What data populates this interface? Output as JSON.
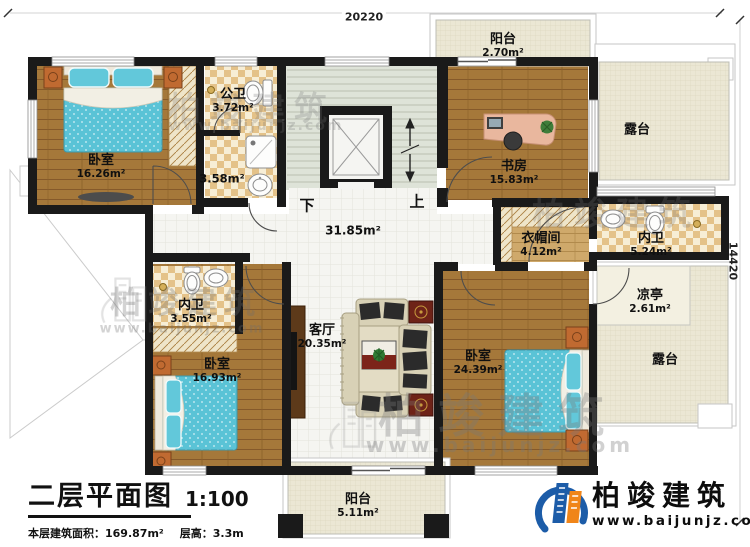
{
  "dimensions": {
    "top": "20220",
    "right": "14420"
  },
  "stairs": {
    "down": "下",
    "up": "上"
  },
  "rooms": {
    "bedroom_tl": {
      "name": "卧室",
      "area": "16.26m²"
    },
    "public_bath": {
      "name": "公卫",
      "area": "3.72m²"
    },
    "shower_room": {
      "area": "3.58m²"
    },
    "hall": {
      "area": "31.85m²"
    },
    "study": {
      "name": "书房",
      "area": "15.83m²"
    },
    "balcony_top": {
      "name": "阳台",
      "area": "2.70m²"
    },
    "terrace_top": {
      "name": "露台"
    },
    "cloakroom": {
      "name": "衣帽间",
      "area": "4.12m²"
    },
    "bath_right": {
      "name": "内卫",
      "area": "5.24m²"
    },
    "pavilion": {
      "name": "凉亭",
      "area": "2.61m²"
    },
    "terrace_right": {
      "name": "露台"
    },
    "bedroom_br": {
      "name": "卧室",
      "area": "24.39m²"
    },
    "living_room": {
      "name": "客厅",
      "area": "20.35m²"
    },
    "bedroom_bl": {
      "name": "卧室",
      "area": "16.93m²"
    },
    "bath_bl": {
      "name": "内卫",
      "area": "3.55m²"
    },
    "balcony_bottom": {
      "name": "阳台",
      "area": "5.11m²"
    }
  },
  "title_block": {
    "title": "二层平面图",
    "scale": "1:100",
    "area_info": "本层建筑面积：169.87m²",
    "height_info": "层高：3.3m"
  },
  "branding": {
    "company": "柏竣建筑",
    "website": "www.baijunjz.com"
  },
  "watermark": {
    "brand": "柏竣建筑",
    "url": "www.baijunjz.com"
  },
  "colors": {
    "wall": "#1a1a1a",
    "wood": "#a5783a",
    "tile_check": "#e4c289",
    "bed": "#5ac3d6",
    "accent_orange": "#f08519",
    "accent_blue": "#1c5ca8"
  }
}
